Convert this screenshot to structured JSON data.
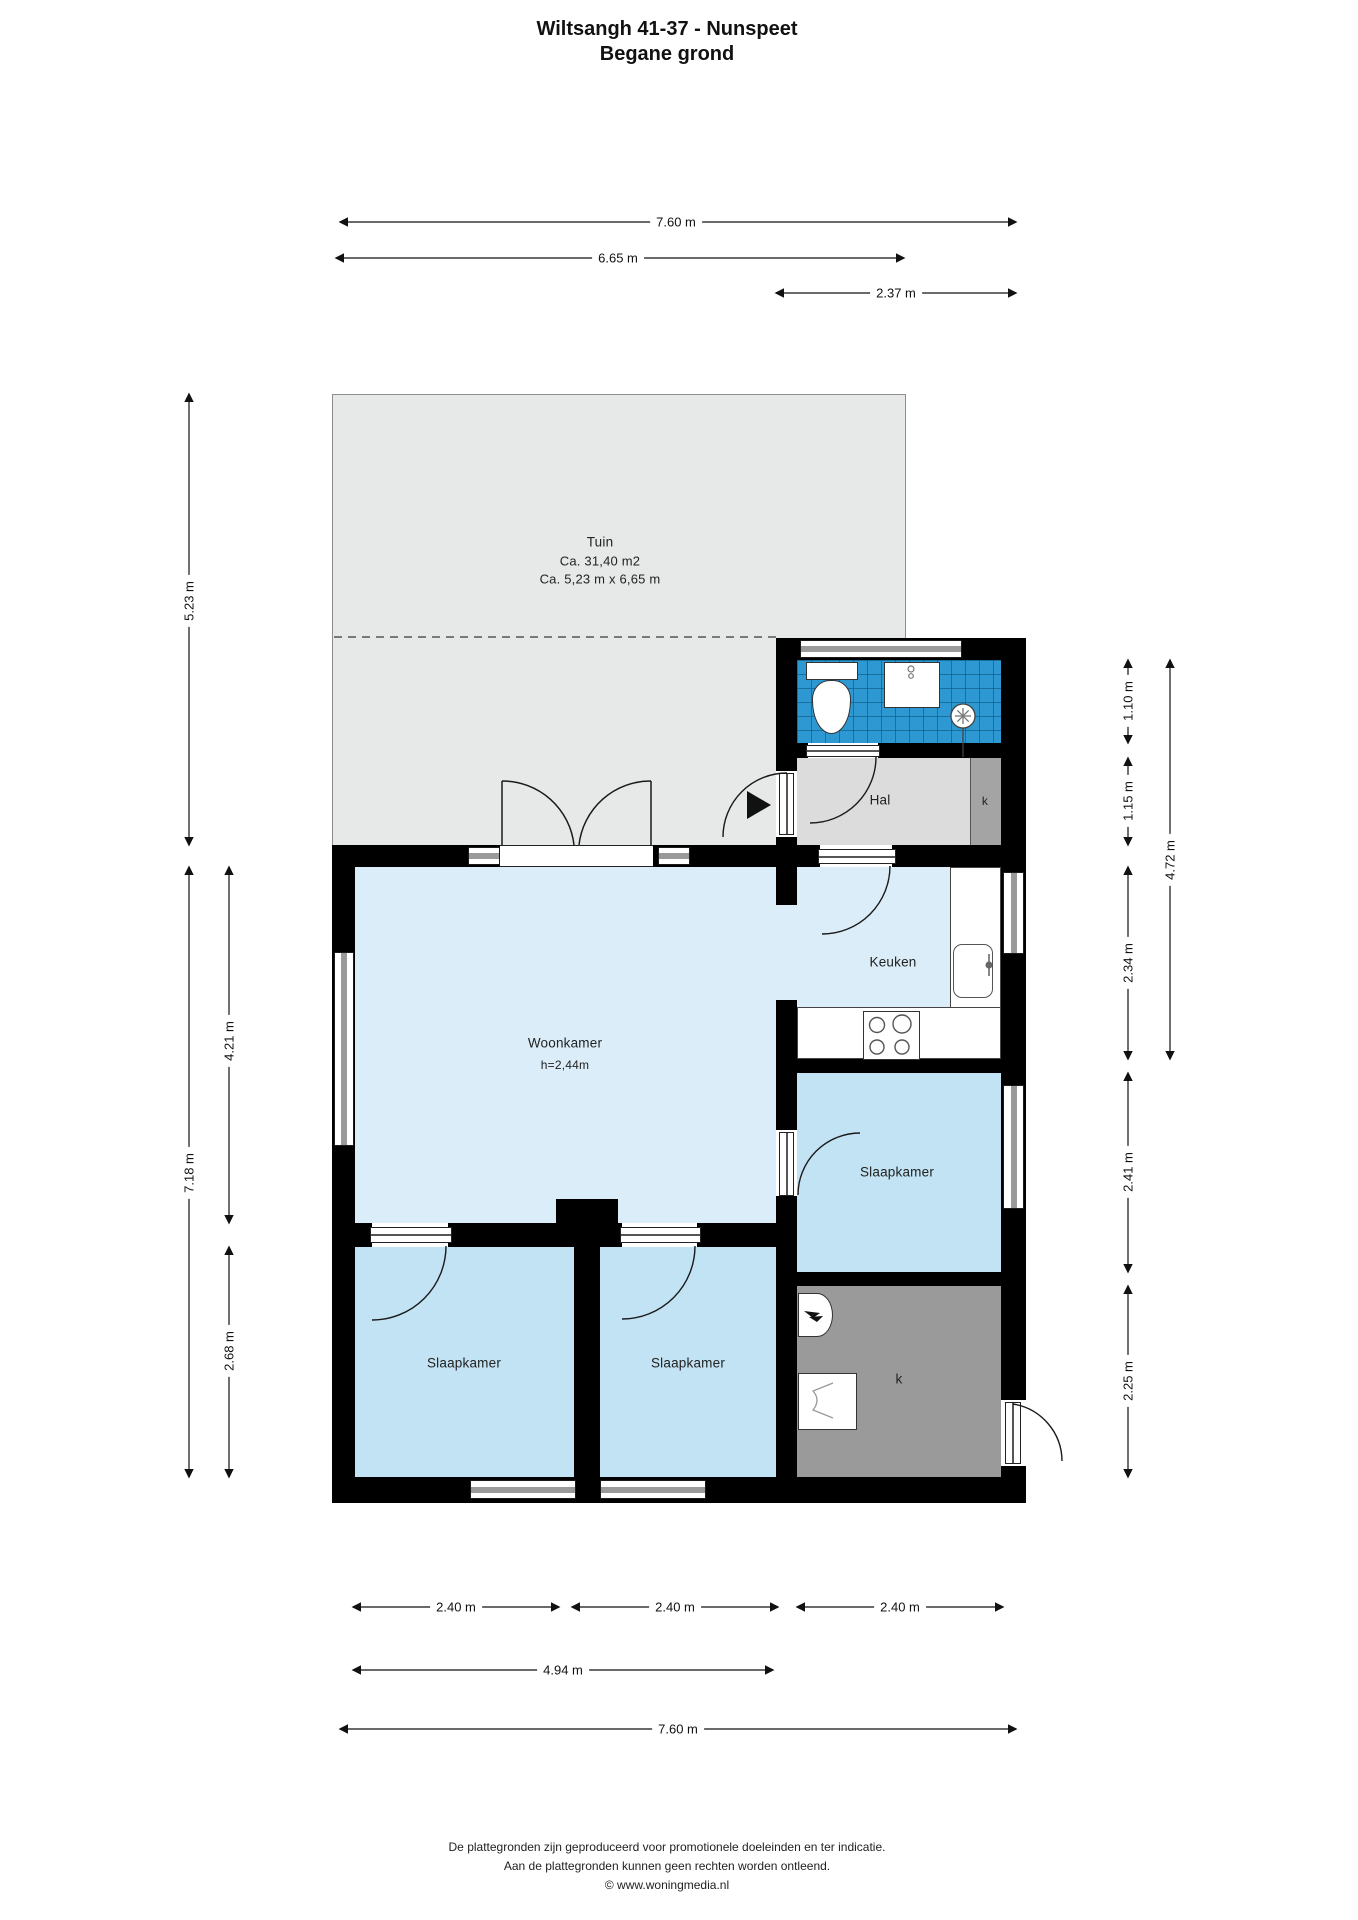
{
  "title": {
    "line1": "Wiltsangh 41-37 - Nunspeet",
    "line2": "Begane grond"
  },
  "rooms": {
    "tuin": {
      "name": "Tuin",
      "area": "Ca. 31,40 m2",
      "size": "Ca. 5,23 m x 6,65 m"
    },
    "hal": {
      "name": "Hal"
    },
    "hal_kast": {
      "name": "k"
    },
    "keuken": {
      "name": "Keuken"
    },
    "woonkamer": {
      "name": "Woonkamer",
      "ceiling_height": "h=2,44m"
    },
    "slaapkamer_rechts": {
      "name": "Slaapkamer"
    },
    "slaapkamer_links": {
      "name": "Slaapkamer"
    },
    "slaapkamer_midden": {
      "name": "Slaapkamer"
    },
    "berging": {
      "name": "k"
    }
  },
  "dimensions": {
    "top": [
      "7.60 m",
      "6.65 m",
      "2.37 m"
    ],
    "left": [
      "5.23 m",
      "7.18 m",
      "4.21 m",
      "2.68 m"
    ],
    "right": [
      "1.10 m",
      "1.15 m",
      "4.72 m",
      "2.34 m",
      "2.41 m",
      "2.25 m"
    ],
    "bottom": [
      "2.40 m",
      "2.40 m",
      "2.40 m",
      "4.94 m",
      "7.60 m"
    ]
  },
  "footer": {
    "line1": "De plattegronden zijn geproduceerd voor promotionele doeleinden en ter indicatie.",
    "line2": "Aan de plattegronden kunnen geen rechten worden ontleend.",
    "line3": "© www.woningmedia.nl"
  },
  "colors": {
    "walls": "#000000",
    "garden_floor": "#e7e8e8",
    "living_floor": "#dbedf8",
    "bedroom_floor": "#c2e3f3",
    "bathroom_tile": "#2d98d2",
    "hall_floor": "#dcdcdc",
    "closet_floor": "#a4a4a4",
    "storage_floor": "#9a9a9a"
  }
}
